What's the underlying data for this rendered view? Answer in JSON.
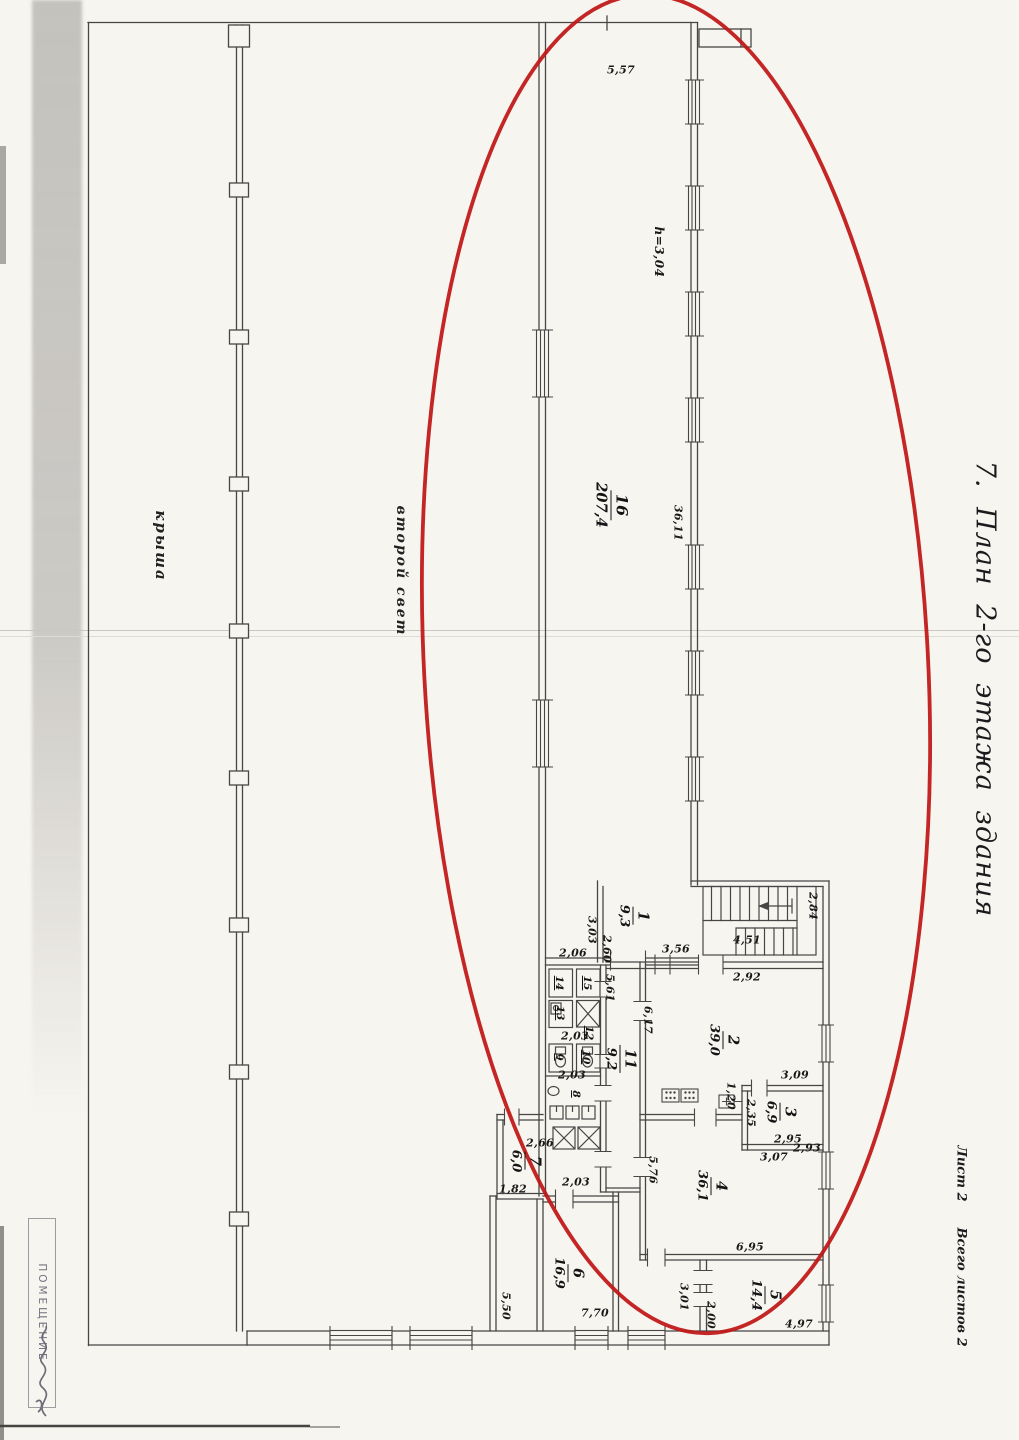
{
  "document": {
    "title": "7. План 2-го этажа здания",
    "sheet_label": "Лист 2",
    "sheet_total_label": "Всего листов 2",
    "stamp_text": "ПОМЕЩЕНИЕ"
  },
  "plan": {
    "annotations": {
      "roof": "крыша",
      "second_light": "второй свет",
      "height_note": "h=3,04"
    },
    "rooms": {
      "r1": {
        "number": "1",
        "area": "9,3"
      },
      "r2": {
        "number": "2",
        "area": "39,0"
      },
      "r3": {
        "number": "3",
        "area": "6,9"
      },
      "r4": {
        "number": "4",
        "area": "36,1"
      },
      "r5": {
        "number": "5",
        "area": "14,4"
      },
      "r6": {
        "number": "6",
        "area": "16,9"
      },
      "r7": {
        "number": "7",
        "area": "6,0"
      },
      "r8": {
        "number": "8"
      },
      "r9": {
        "number": "9"
      },
      "r10": {
        "number": "10"
      },
      "r11": {
        "number": "11",
        "area": "9,2"
      },
      "r12": {
        "number": "12"
      },
      "r13": {
        "number": "13"
      },
      "r14": {
        "number": "14"
      },
      "r15": {
        "number": "15"
      },
      "r16": {
        "number": "16",
        "area": "207,4"
      }
    },
    "dimensions": {
      "d5_57": "5,57",
      "d36_11": "36,11",
      "d3_03": "3,03",
      "d2_60": "2,60",
      "d3_56": "3,56",
      "d4_51": "4,51",
      "d2_84": "2,84",
      "d2_92": "2,92",
      "d6_17": "6,17",
      "d3_09": "3,09",
      "d1_20": "1,20",
      "d2_35": "2,35",
      "d2_95": "2,95",
      "d2_93": "2,93",
      "d3_07": "3,07",
      "d5_76": "5,76",
      "d6_95": "6,95",
      "d4_97": "4,97",
      "d3_01": "3,01",
      "d2_00": "2,00",
      "d7_70": "7,70",
      "d5_50": "5,50",
      "d1_82": "1,82",
      "d2_66": "2,66",
      "d2_06": "2,06",
      "d2_03a": "2,03",
      "d2_03b": "2,03",
      "d2_03c": "2,03",
      "d5_61": "5,61"
    },
    "annotation_color": "#c01515"
  }
}
